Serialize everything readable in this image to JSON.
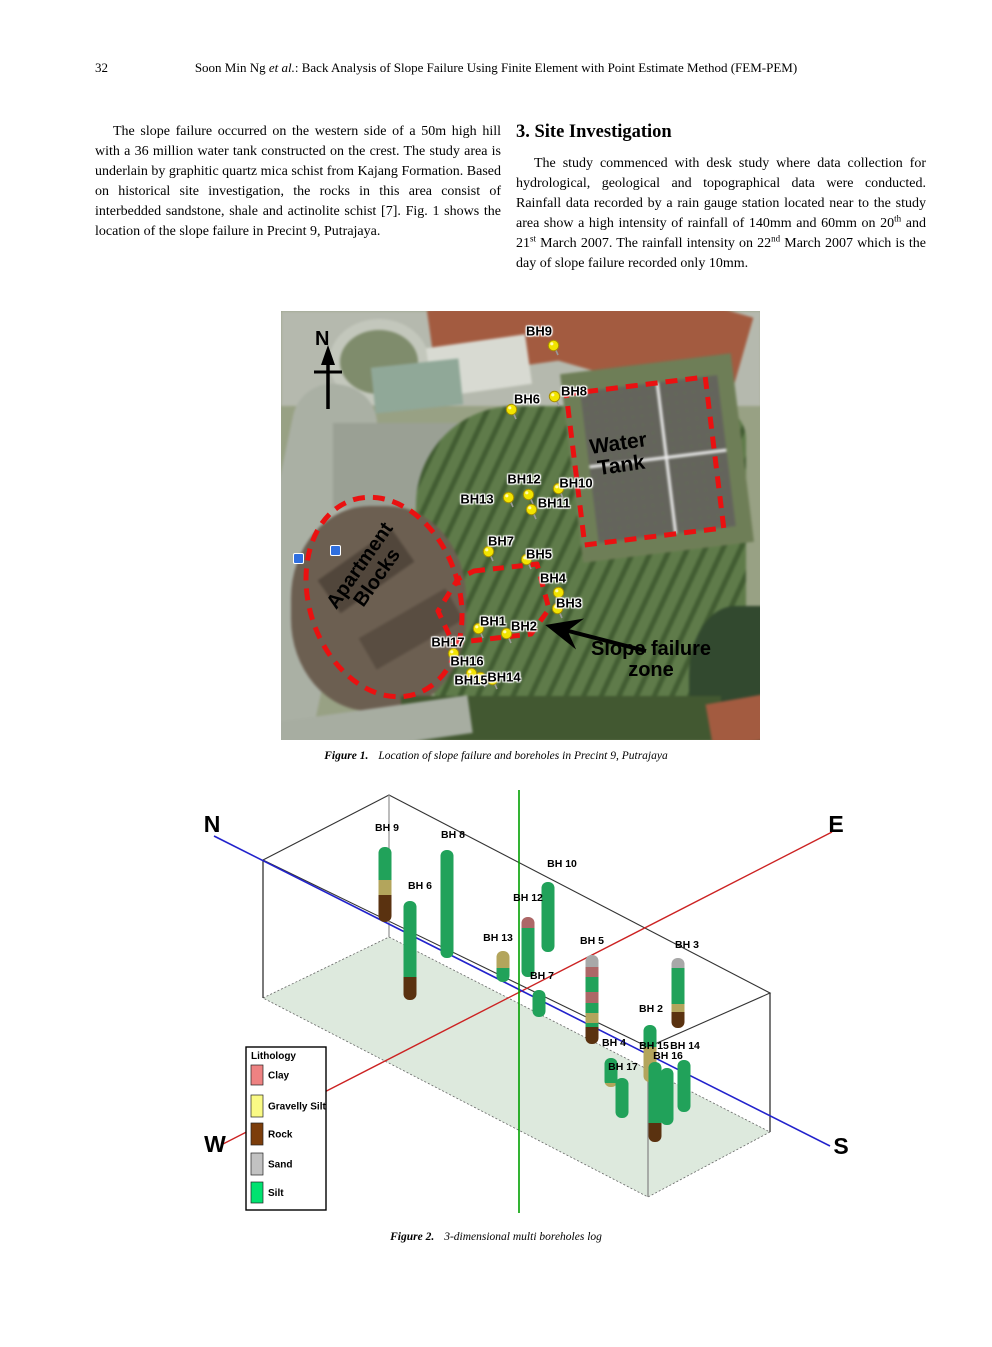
{
  "header": {
    "page_number": "32",
    "authors": "Soon Min Ng ",
    "etal": "et al.",
    "rest": ":   Back Analysis of Slope Failure Using Finite Element with Point Estimate Method (FEM-PEM)"
  },
  "intro": {
    "paragraph": "The slope failure occurred on the western side of a 50m high hill with a 36 million water tank constructed on the crest. The study area is underlain by graphitic quartz mica schist from Kajang Formation. Based on historical site investigation, the rocks in this area consist of interbedded sandstone, shale and actinolite schist [7]. Fig. 1 shows the location of the slope failure in Precint 9, Putrajaya."
  },
  "site": {
    "heading": "3. Site Investigation",
    "p1": "The study commenced with desk study where data collection for hydrological, geological and topographical data were conducted. Rainfall data recorded by a rain gauge station located near to the study area show a high intensity of rainfall of 140mm and 60mm on 20",
    "sup1": "th",
    "p2": " and 21",
    "sup2": "st",
    "p3": " March 2007. The rainfall intensity on 22",
    "sup3": "nd",
    "p4": " March 2007 which is the day of slope failure recorded only 10mm."
  },
  "figure1": {
    "north_label": "N",
    "water_tank": {
      "line1": "Water",
      "line2": "Tank"
    },
    "apartment": {
      "line1": "Apartment",
      "line2": "Blocks"
    },
    "slope_zone": {
      "line1": "Slope failure",
      "line2": "zone"
    },
    "caption_label": "Figure 1.",
    "caption_text": "Location of slope failure and boreholes in Precint 9, Putrajaya",
    "pins": [
      {
        "name": "BH9",
        "label_x": 258,
        "label_y": 20,
        "pin_x": 272,
        "pin_y": 34
      },
      {
        "name": "BH8",
        "label_x": 293,
        "label_y": 80,
        "pin_x": 273,
        "pin_y": 85
      },
      {
        "name": "BH6",
        "label_x": 246,
        "label_y": 88,
        "pin_x": 230,
        "pin_y": 98
      },
      {
        "name": "BH12",
        "label_x": 243,
        "label_y": 168,
        "pin_x": 247,
        "pin_y": 183
      },
      {
        "name": "BH10",
        "label_x": 295,
        "label_y": 172,
        "pin_x": 277,
        "pin_y": 177
      },
      {
        "name": "BH13",
        "label_x": 196,
        "label_y": 188,
        "pin_x": 227,
        "pin_y": 186
      },
      {
        "name": "BH11",
        "label_x": 273,
        "label_y": 192,
        "pin_x": 250,
        "pin_y": 198
      },
      {
        "name": "BH7",
        "label_x": 220,
        "label_y": 230,
        "pin_x": 207,
        "pin_y": 240
      },
      {
        "name": "BH5",
        "label_x": 258,
        "label_y": 243,
        "pin_x": 245,
        "pin_y": 248
      },
      {
        "name": "BH4",
        "label_x": 272,
        "label_y": 267,
        "pin_x": 277,
        "pin_y": 281
      },
      {
        "name": "BH3",
        "label_x": 288,
        "label_y": 292,
        "pin_x": 276,
        "pin_y": 297
      },
      {
        "name": "BH1",
        "label_x": 212,
        "label_y": 310,
        "pin_x": 197,
        "pin_y": 317
      },
      {
        "name": "BH2",
        "label_x": 243,
        "label_y": 315,
        "pin_x": 225,
        "pin_y": 322
      },
      {
        "name": "BH17",
        "label_x": 167,
        "label_y": 331,
        "pin_x": 172,
        "pin_y": 342
      },
      {
        "name": "BH16",
        "label_x": 186,
        "label_y": 350,
        "pin_x": 190,
        "pin_y": 362
      },
      {
        "name": "BH15",
        "label_x": 190,
        "label_y": 369,
        "pin_x": 199,
        "pin_y": 366
      },
      {
        "name": "BH14",
        "label_x": 223,
        "label_y": 366,
        "pin_x": 211,
        "pin_y": 368
      }
    ]
  },
  "figure2_caption": {
    "label": "Figure 2.",
    "text": "3-dimensional multi boreholes log"
  },
  "chart_data": {
    "type": "bar",
    "title": "3-dimensional multi boreholes log",
    "legend_position": "bottom-left",
    "legend_title": "Lithology",
    "legend": [
      {
        "label": "Clay",
        "color": "#ee8282"
      },
      {
        "label": "Gravelly Silt",
        "color": "#fafa85"
      },
      {
        "label": "Rock",
        "color": "#7c3d0b"
      },
      {
        "label": "Sand",
        "color": "#c2c2c2"
      },
      {
        "label": "Silt",
        "color": "#00e270"
      }
    ],
    "column_colors": {
      "Clay": "#ad6767",
      "Gravelly Silt": "#b3a55c",
      "Rock": "#5a3210",
      "Sand": "#a8a8a8",
      "Silt": "#21a25a"
    },
    "axes": {
      "north": "N",
      "east": "E",
      "west": "W",
      "south": "S"
    },
    "axis_colors": {
      "north_south": "#2222cc",
      "west_east": "#cc2222",
      "vertical": "#00a000"
    },
    "boreholes": [
      {
        "name": "BH 9",
        "x": 195,
        "label": [
          197,
          40
        ],
        "segments": [
          [
            "Silt",
            59,
            92
          ],
          [
            "Gravelly Silt",
            92,
            107
          ],
          [
            "Rock",
            107,
            134
          ]
        ]
      },
      {
        "name": "BH 8",
        "x": 257,
        "label": [
          263,
          47
        ],
        "segments": [
          [
            "Silt",
            62,
            170
          ]
        ]
      },
      {
        "name": "BH 6",
        "x": 220,
        "label": [
          230,
          98
        ],
        "segments": [
          [
            "Silt",
            113,
            189
          ],
          [
            "Rock",
            189,
            212
          ]
        ]
      },
      {
        "name": "BH 10",
        "x": 358,
        "label": [
          372,
          76
        ],
        "segments": [
          [
            "Silt",
            94,
            164
          ]
        ]
      },
      {
        "name": "BH 12",
        "x": 338,
        "label": [
          338,
          110
        ],
        "segments": [
          [
            "Clay",
            129,
            140
          ],
          [
            "Silt",
            140,
            189
          ]
        ]
      },
      {
        "name": "BH 13",
        "x": 313,
        "label": [
          308,
          150
        ],
        "segments": [
          [
            "Gravelly Silt",
            163,
            180
          ],
          [
            "Silt",
            180,
            194
          ]
        ]
      },
      {
        "name": "BH 7",
        "x": 349,
        "label": [
          352,
          188
        ],
        "segments": [
          [
            "Silt",
            202,
            229
          ]
        ]
      },
      {
        "name": "BH 5",
        "x": 402,
        "label": [
          402,
          153
        ],
        "segments": [
          [
            "Sand",
            167,
            179
          ],
          [
            "Clay",
            179,
            189
          ],
          [
            "Silt",
            189,
            204
          ],
          [
            "Clay",
            204,
            215
          ],
          [
            "Silt",
            215,
            225
          ],
          [
            "Gravelly Silt",
            225,
            235
          ],
          [
            "Silt",
            235,
            239
          ],
          [
            "Rock",
            239,
            256
          ]
        ]
      },
      {
        "name": "BH 3",
        "x": 488,
        "label": [
          497,
          157
        ],
        "segments": [
          [
            "Sand",
            170,
            180
          ],
          [
            "Silt",
            180,
            216
          ],
          [
            "Gravelly Silt",
            216,
            224
          ],
          [
            "Rock",
            224,
            240
          ]
        ]
      },
      {
        "name": "BH 2",
        "x": 460,
        "label": [
          461,
          221
        ],
        "segments": [
          [
            "Silt",
            237,
            259
          ],
          [
            "Gravelly Silt",
            259,
            294
          ]
        ]
      },
      {
        "name": "BH 4",
        "x": 421,
        "label": [
          424,
          255
        ],
        "segments": [
          [
            "Silt",
            270,
            295
          ],
          [
            "Gravelly Silt",
            295,
            299
          ]
        ]
      },
      {
        "name": "BH 15",
        "x": 465,
        "label": [
          464,
          258
        ],
        "segments": [
          [
            "Silt",
            274,
            335
          ],
          [
            "Rock",
            335,
            354
          ]
        ]
      },
      {
        "name": "BH 14",
        "x": 494,
        "label": [
          495,
          258
        ],
        "segments": [
          [
            "Silt",
            272,
            324
          ]
        ]
      },
      {
        "name": "BH 16",
        "x": 477,
        "label": [
          478,
          268
        ],
        "segments": [
          [
            "Silt",
            280,
            337
          ]
        ]
      },
      {
        "name": "BH 17",
        "x": 432,
        "label": [
          433,
          279
        ],
        "segments": [
          [
            "Silt",
            290,
            330
          ]
        ]
      }
    ]
  }
}
